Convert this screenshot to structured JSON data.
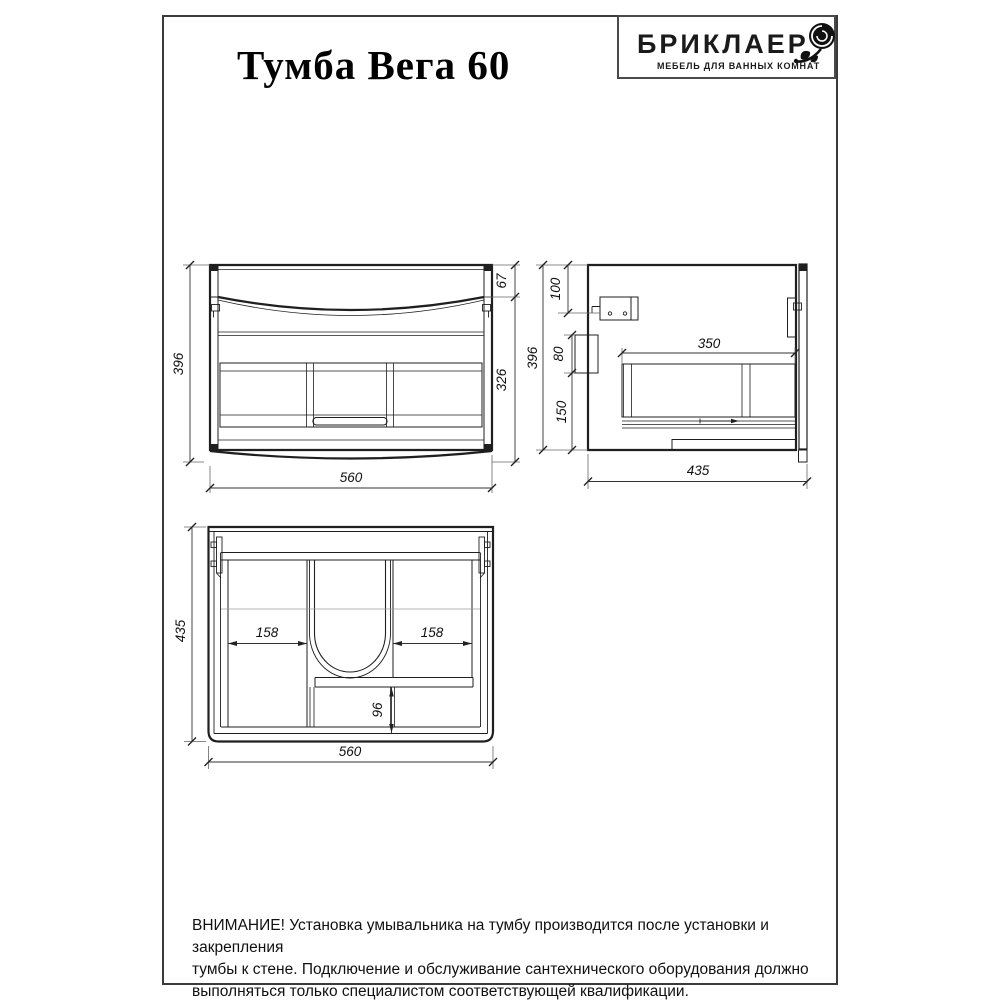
{
  "page": {
    "title": "Тумба Вега 60",
    "logo": {
      "brand": "БРИКЛАЕР",
      "tagline": "МЕБЕЛЬ ДЛЯ ВАННЫХ КОМНАТ",
      "rose_icon": "rose-icon"
    },
    "warning_lines": [
      "ВНИМАНИЕ! Установка умывальника на тумбу производится после установки и закрепления",
      "тумбы к стене. Подключение и обслуживание сантехнического оборудования должно",
      "выполняться только специалистом соответствующей квалификации."
    ],
    "colors": {
      "ink": "#1f1f1f",
      "dim_lines": "#555555",
      "centerline": "#9b9b9b",
      "background": "#ffffff"
    }
  },
  "views": {
    "front": {
      "dims": {
        "height": "396",
        "top_section": "67",
        "lower_section": "326",
        "width": "560"
      }
    },
    "side": {
      "dims": {
        "height": "396",
        "bracket_offset": "100",
        "bracket_height": "80",
        "lower_offset": "150",
        "drawer_width": "350",
        "depth": "435"
      }
    },
    "top": {
      "dims": {
        "depth": "435",
        "left_drawer_width": "158",
        "right_drawer_width": "158",
        "center_gap": "96",
        "width": "560"
      }
    }
  }
}
